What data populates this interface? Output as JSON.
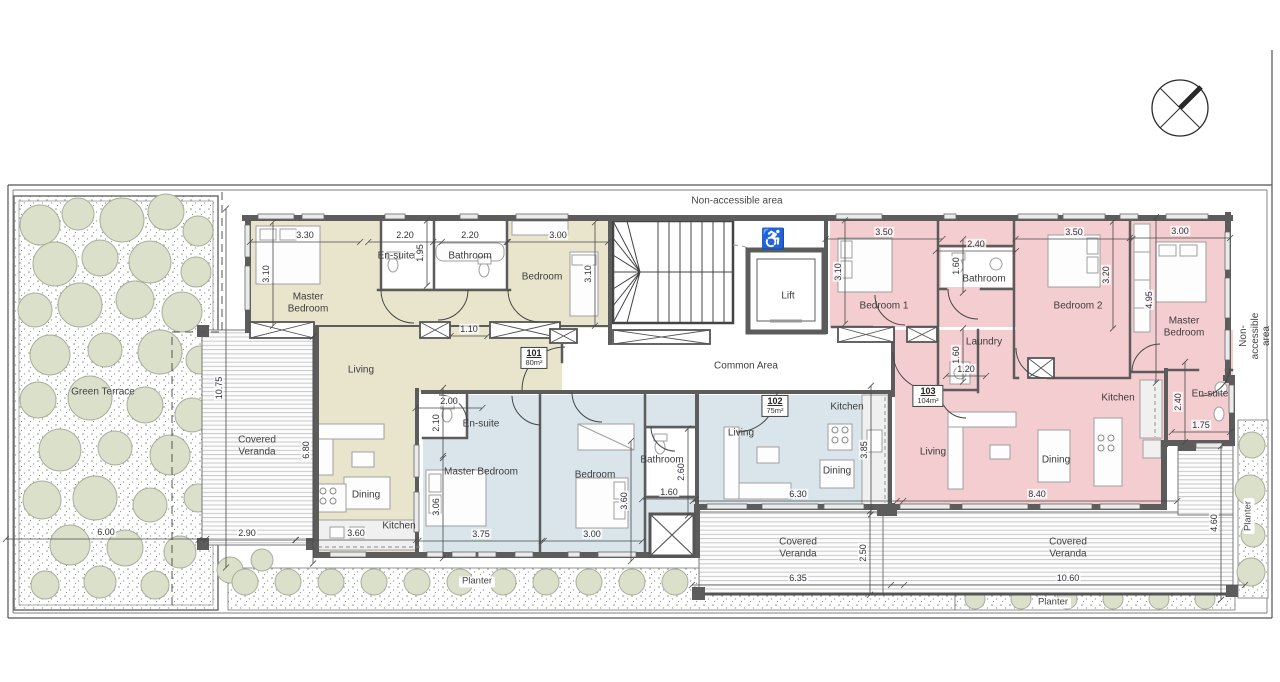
{
  "colors": {
    "wall": "#5c5c5c",
    "unit101": "#e9e5cd",
    "unit102": "#d9e5ea",
    "unit103": "#f4cdd0",
    "tree": "#dae0ca",
    "treeline": "#a9ae9b",
    "dimline": "#4a4a4a"
  },
  "plan": {
    "units": [
      {
        "number": "101",
        "area": "80m²",
        "x": 534,
        "y": 358
      },
      {
        "number": "102",
        "area": "75m²",
        "x": 775,
        "y": 406
      },
      {
        "number": "103",
        "area": "104m²",
        "x": 928,
        "y": 396
      }
    ],
    "annotations": [
      {
        "id": "dim-101-master-width",
        "type": "dim",
        "text": "3.30",
        "x": 305,
        "y": 235
      },
      {
        "id": "dim-101-ensuite-width",
        "type": "dim",
        "text": "2.20",
        "x": 405,
        "y": 235
      },
      {
        "id": "dim-101-bath-width",
        "type": "dim",
        "text": "2.20",
        "x": 470,
        "y": 235
      },
      {
        "id": "dim-101-bedroom-width",
        "type": "dim",
        "text": "3.00",
        "x": 558,
        "y": 235
      },
      {
        "id": "dim-101-ensuite-depth",
        "type": "dim",
        "text": "1.95",
        "x": 420,
        "y": 253,
        "rot": -90
      },
      {
        "id": "dim-101-master-depth",
        "type": "dim",
        "text": "3.10",
        "x": 266,
        "y": 274,
        "rot": -90
      },
      {
        "id": "dim-101-bedroom-depth",
        "type": "dim",
        "text": "3.10",
        "x": 588,
        "y": 274,
        "rot": -90
      },
      {
        "id": "dim-101-hall-width",
        "type": "dim",
        "text": "1.10",
        "x": 469,
        "y": 329
      },
      {
        "id": "dim-terrace-height",
        "type": "dim",
        "text": "10.75",
        "x": 219,
        "y": 388,
        "rot": -90
      },
      {
        "id": "dim-101-living-depth",
        "type": "dim",
        "text": "6.80",
        "x": 306,
        "y": 450,
        "rot": -90
      },
      {
        "id": "dim-101-veranda-width",
        "type": "dim",
        "text": "2.90",
        "x": 247,
        "y": 533
      },
      {
        "id": "dim-101-kitchen-width",
        "type": "dim",
        "text": "3.60",
        "x": 356,
        "y": 533
      },
      {
        "id": "dim-terrace-width",
        "type": "dim",
        "text": "6.00",
        "x": 106,
        "y": 532
      },
      {
        "id": "dim-102-ensuite-width",
        "type": "dim",
        "text": "2.00",
        "x": 449,
        "y": 401
      },
      {
        "id": "dim-102-ensuite-depth",
        "type": "dim",
        "text": "2.10",
        "x": 436,
        "y": 423,
        "rot": -90
      },
      {
        "id": "dim-102-master-depth",
        "type": "dim",
        "text": "3.06",
        "x": 436,
        "y": 507,
        "rot": -90
      },
      {
        "id": "dim-102-master-width",
        "type": "dim",
        "text": "3.75",
        "x": 481,
        "y": 534
      },
      {
        "id": "dim-102-bedroom-depth",
        "type": "dim",
        "text": "3.60",
        "x": 624,
        "y": 501,
        "rot": -90
      },
      {
        "id": "dim-102-bedroom-width",
        "type": "dim",
        "text": "3.00",
        "x": 592,
        "y": 534
      },
      {
        "id": "dim-102-bath-depth",
        "type": "dim",
        "text": "2.60",
        "x": 681,
        "y": 472,
        "rot": -90
      },
      {
        "id": "dim-102-bath-width",
        "type": "dim",
        "text": "1.60",
        "x": 669,
        "y": 492
      },
      {
        "id": "dim-102-living-width",
        "type": "dim",
        "text": "6.30",
        "x": 798,
        "y": 494
      },
      {
        "id": "dim-102-living-depth",
        "type": "dim",
        "text": "3.85",
        "x": 864,
        "y": 450,
        "rot": -90
      },
      {
        "id": "dim-102-veranda-width",
        "type": "dim",
        "text": "6.35",
        "x": 798,
        "y": 578
      },
      {
        "id": "dim-102-veranda-depth",
        "type": "dim",
        "text": "2.50",
        "x": 863,
        "y": 553,
        "rot": -90
      },
      {
        "id": "dim-103-bedroom1-width",
        "type": "dim",
        "text": "3.50",
        "x": 884,
        "y": 232
      },
      {
        "id": "dim-103-bedroom1-depth",
        "type": "dim",
        "text": "3.10",
        "x": 838,
        "y": 272,
        "rot": -90
      },
      {
        "id": "dim-103-bath-width",
        "type": "dim",
        "text": "2.40",
        "x": 976,
        "y": 244
      },
      {
        "id": "dim-103-bath-depth",
        "type": "dim",
        "text": "1.60",
        "x": 956,
        "y": 266,
        "rot": -90
      },
      {
        "id": "dim-103-bedroom2-width",
        "type": "dim",
        "text": "3.50",
        "x": 1074,
        "y": 232
      },
      {
        "id": "dim-103-bedroom2-depth",
        "type": "dim",
        "text": "3.20",
        "x": 1106,
        "y": 275,
        "rot": -90
      },
      {
        "id": "dim-103-master-width",
        "type": "dim",
        "text": "3.00",
        "x": 1180,
        "y": 231
      },
      {
        "id": "dim-103-master-depth",
        "type": "dim",
        "text": "4.95",
        "x": 1149,
        "y": 300,
        "rot": -90
      },
      {
        "id": "dim-103-laundry-depth",
        "type": "dim",
        "text": "1.60",
        "x": 956,
        "y": 355,
        "rot": -90
      },
      {
        "id": "dim-103-laundry-width",
        "type": "dim",
        "text": "1.20",
        "x": 966,
        "y": 369
      },
      {
        "id": "dim-103-living-width",
        "type": "dim",
        "text": "8.40",
        "x": 1037,
        "y": 494
      },
      {
        "id": "dim-103-veranda-width",
        "type": "dim",
        "text": "10.60",
        "x": 1068,
        "y": 578
      },
      {
        "id": "dim-103-veranda-depth",
        "type": "dim",
        "text": "4.60",
        "x": 1214,
        "y": 523,
        "rot": -90
      },
      {
        "id": "dim-103-ensuite-depth",
        "type": "dim",
        "text": "2.40",
        "x": 1178,
        "y": 402,
        "rot": -90
      },
      {
        "id": "dim-103-ensuite-width",
        "type": "dim",
        "text": "1.75",
        "x": 1201,
        "y": 425
      },
      {
        "id": "label-101-master",
        "type": "room",
        "text": "Master\nBedroom",
        "x": 308,
        "y": 303
      },
      {
        "id": "label-101-ensuite",
        "type": "room",
        "text": "En-suite",
        "x": 396,
        "y": 256
      },
      {
        "id": "label-101-bath",
        "type": "room",
        "text": "Bathroom",
        "x": 470,
        "y": 256
      },
      {
        "id": "label-101-bedroom",
        "type": "room",
        "text": "Bedroom",
        "x": 542,
        "y": 277
      },
      {
        "id": "label-101-living",
        "type": "room",
        "text": "Living",
        "x": 361,
        "y": 370
      },
      {
        "id": "label-101-dining",
        "type": "room",
        "text": "Dining",
        "x": 366,
        "y": 495
      },
      {
        "id": "label-101-kitchen",
        "type": "room",
        "text": "Kitchen",
        "x": 399,
        "y": 526
      },
      {
        "id": "label-102-ensuite",
        "type": "room",
        "text": "En-suite",
        "x": 481,
        "y": 424
      },
      {
        "id": "label-102-master",
        "type": "room",
        "text": "Master Bedroom",
        "x": 481,
        "y": 472
      },
      {
        "id": "label-102-bedroom",
        "type": "room",
        "text": "Bedroom",
        "x": 595,
        "y": 475
      },
      {
        "id": "label-102-bath",
        "type": "room",
        "text": "Bathroom",
        "x": 662,
        "y": 460
      },
      {
        "id": "label-102-living",
        "type": "room",
        "text": "Living",
        "x": 741,
        "y": 433
      },
      {
        "id": "label-102-kitchen",
        "type": "room",
        "text": "Kitchen",
        "x": 847,
        "y": 407
      },
      {
        "id": "label-102-dining",
        "type": "room",
        "text": "Dining",
        "x": 837,
        "y": 471
      },
      {
        "id": "label-103-bedroom1",
        "type": "room",
        "text": "Bedroom 1",
        "x": 884,
        "y": 306
      },
      {
        "id": "label-103-bath",
        "type": "room",
        "text": "Bathroom",
        "x": 984,
        "y": 279
      },
      {
        "id": "label-103-bedroom2",
        "type": "room",
        "text": "Bedroom 2",
        "x": 1078,
        "y": 306
      },
      {
        "id": "label-103-master",
        "type": "room",
        "text": "Master\nBedroom",
        "x": 1184,
        "y": 327
      },
      {
        "id": "label-103-laundry",
        "type": "room",
        "text": "Laundry",
        "x": 984,
        "y": 342
      },
      {
        "id": "label-103-kitchen",
        "type": "room",
        "text": "Kitchen",
        "x": 1118,
        "y": 398
      },
      {
        "id": "label-103-ensuite",
        "type": "room",
        "text": "En-suite",
        "x": 1210,
        "y": 394
      },
      {
        "id": "label-103-living",
        "type": "room",
        "text": "Living",
        "x": 933,
        "y": 452
      },
      {
        "id": "label-103-dining",
        "type": "room",
        "text": "Dining",
        "x": 1056,
        "y": 460
      },
      {
        "id": "label-lift",
        "type": "room",
        "text": "Lift",
        "x": 788,
        "y": 296
      },
      {
        "id": "label-common-area",
        "type": "room",
        "text": "Common Area",
        "x": 746,
        "y": 366
      },
      {
        "id": "label-non-accessible-top",
        "type": "site",
        "text": "Non-accessible area",
        "x": 737,
        "y": 201
      },
      {
        "id": "label-non-accessible-right",
        "type": "site",
        "text": "Non-accessible area",
        "x": 1255,
        "y": 336,
        "rot": -90
      },
      {
        "id": "label-green-terrace",
        "type": "site",
        "text": "Green Terrace",
        "x": 103,
        "y": 392
      },
      {
        "id": "label-veranda-left",
        "type": "site",
        "text": "Covered\nVeranda",
        "x": 257,
        "y": 446
      },
      {
        "id": "label-veranda-mid",
        "type": "site",
        "text": "Covered\nVeranda",
        "x": 798,
        "y": 548
      },
      {
        "id": "label-veranda-right",
        "type": "site",
        "text": "Covered\nVeranda",
        "x": 1068,
        "y": 548
      },
      {
        "id": "label-planter-bottom-left",
        "type": "planter",
        "text": "Planter",
        "x": 477,
        "y": 582
      },
      {
        "id": "label-planter-bottom-right",
        "type": "planter",
        "text": "Planter",
        "x": 1053,
        "y": 603
      },
      {
        "id": "label-planter-side",
        "type": "planter",
        "text": "Planter",
        "x": 1249,
        "y": 516,
        "rot": -90
      },
      {
        "id": "wheelchair-icon",
        "type": "icon",
        "text": "♿",
        "x": 773,
        "y": 240
      }
    ]
  }
}
